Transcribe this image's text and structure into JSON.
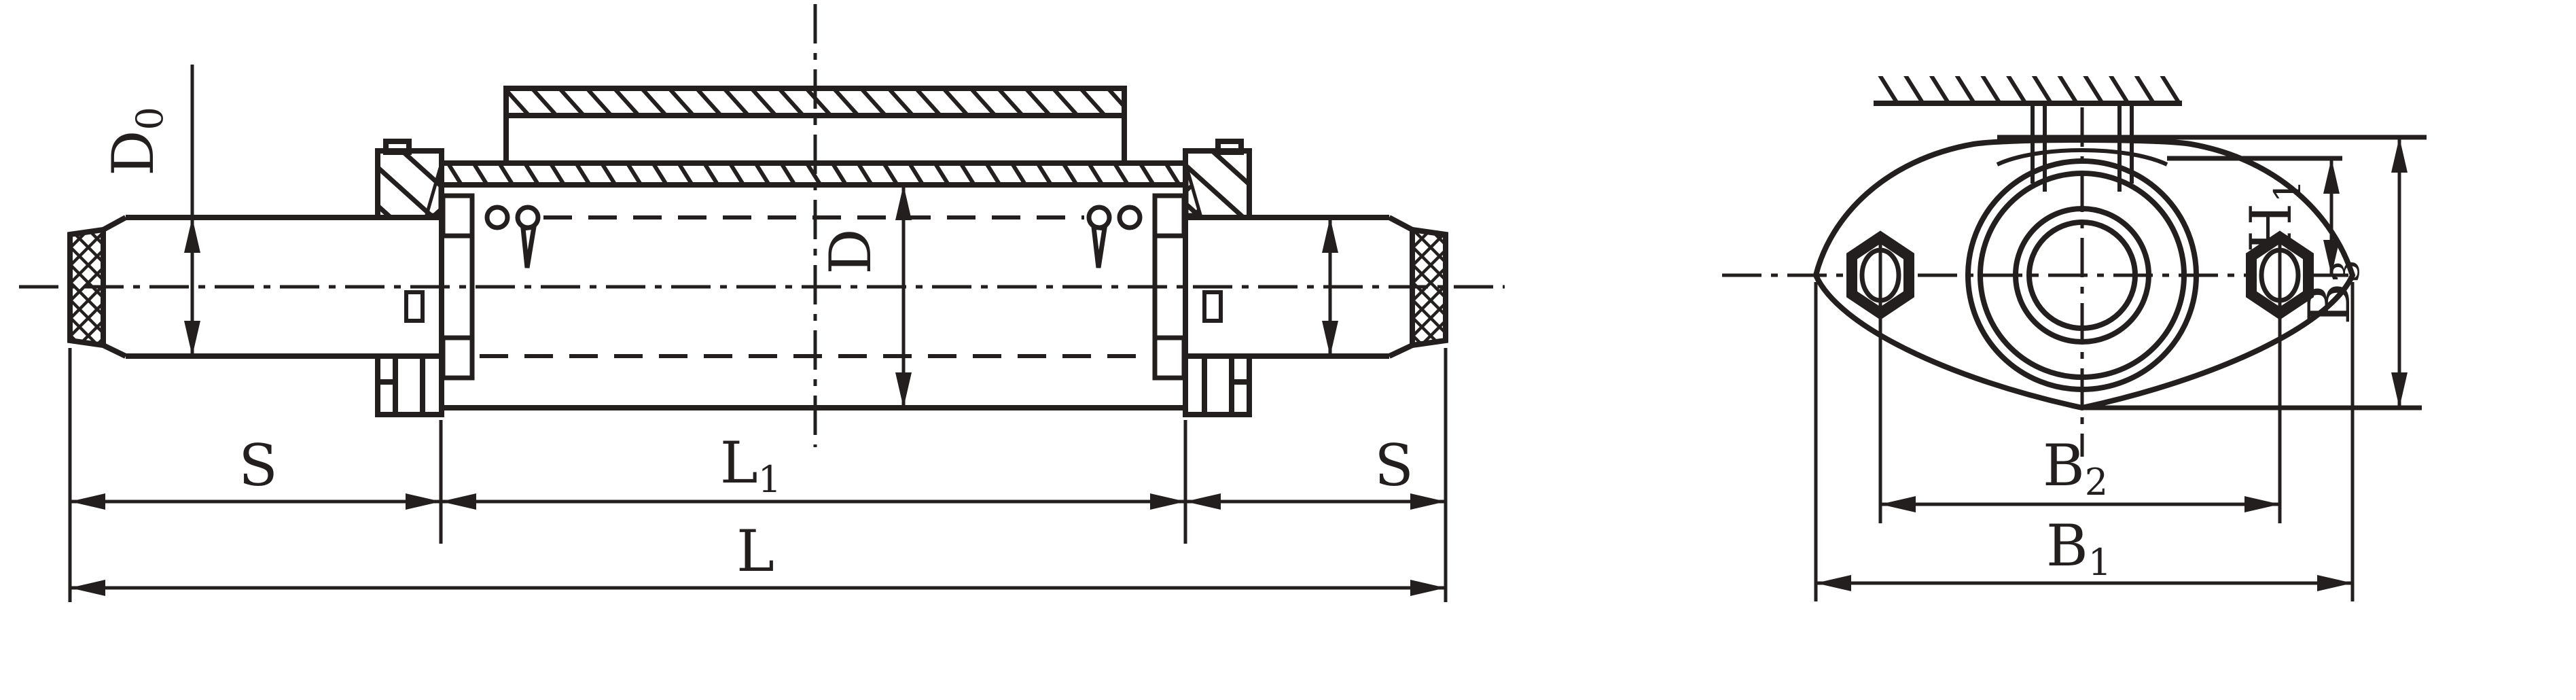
{
  "drawing": {
    "type": "engineering-drawing",
    "description": "Sectioned side view of a shaft/roller assembly with flanged end view",
    "ink_color": "#241f1f",
    "background_color": "#ffffff",
    "labels": {
      "shaft_end_diameter": {
        "main": "D",
        "sub": "0"
      },
      "body_diameter": {
        "main": "D",
        "sub": ""
      },
      "s_left": {
        "main": "S",
        "sub": ""
      },
      "l1_body_length": {
        "main": "L",
        "sub": "1"
      },
      "s_right": {
        "main": "S",
        "sub": ""
      },
      "l_total_length": {
        "main": "L",
        "sub": ""
      },
      "h1_height": {
        "main": "H",
        "sub": "1"
      },
      "b3_total_height": {
        "main": "B",
        "sub": "3"
      },
      "b2_bolt_spacing": {
        "main": "B",
        "sub": "2"
      },
      "b1_flange_width": {
        "main": "B",
        "sub": "1"
      }
    }
  }
}
